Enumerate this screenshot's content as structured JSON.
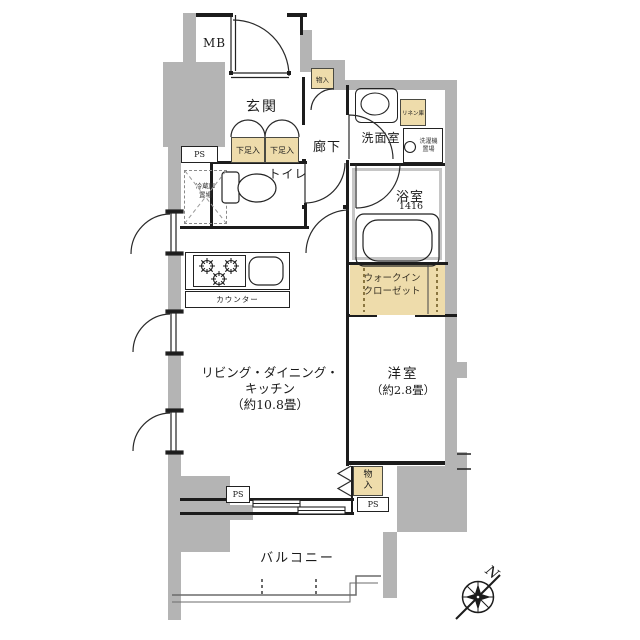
{
  "plan": {
    "title": "one-room-apartment-floor-plan",
    "labels": {
      "meter_box": "MB",
      "pipe_space": "PS",
      "entrance": "玄関",
      "storage_top": "物入",
      "shoe_cabinet": "下足入",
      "hallway": "廊下",
      "washroom": "洗面室",
      "linen_cabinet": "リネン庫",
      "washer_line1": "洗濯機",
      "washer_line2": "置場",
      "bathroom": "浴室",
      "bathroom_size": "1416",
      "toilet": "トイレ",
      "fridge_line1": "冷蔵庫",
      "fridge_line2": "置場",
      "counter": "カウンター",
      "wic_line1": "ウォークイン",
      "wic_line2": "クローゼット",
      "ldk_line1": "リビング・ダイニング・",
      "ldk_line2": "キッチン",
      "ldk_line3": "（約10.8畳）",
      "western_line1": "洋室",
      "western_line2": "（約2.8畳）",
      "balcony": "バルコニー",
      "storage_bottom_char1": "物",
      "storage_bottom_char2": "入",
      "compass_north": "N"
    },
    "colors": {
      "wall_gray": "#b4b4b4",
      "storage_fill": "#eedcab",
      "line": "#1c1c1c"
    }
  }
}
